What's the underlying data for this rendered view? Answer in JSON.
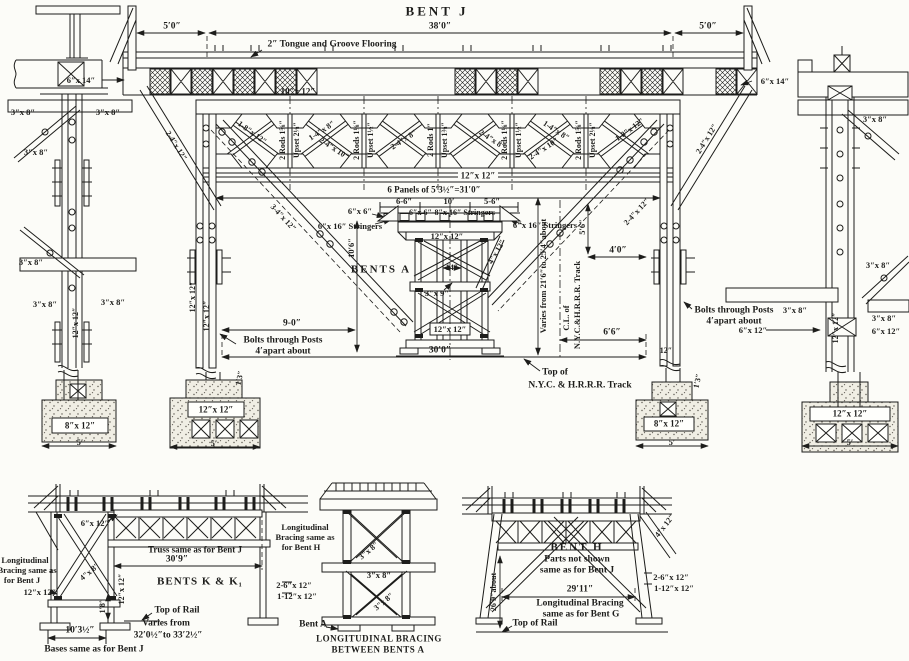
{
  "drawing": {
    "title": "BENT J",
    "colors": {
      "ink": "#1d1d1b",
      "paper": "#fcfcf8"
    },
    "annotations": [
      {
        "n": "title-bent-j",
        "t": "BENT J",
        "x": 437,
        "y": 11,
        "fs": 13,
        "ls": 3
      },
      {
        "n": "dim-5-0-left",
        "t": "5′0″",
        "x": 172,
        "y": 27,
        "fs": 9.5
      },
      {
        "n": "dim-38-0",
        "t": "38′0″",
        "x": 440,
        "y": 27,
        "fs": 9.5
      },
      {
        "n": "dim-5-0-right",
        "t": "5′0″",
        "x": 708,
        "y": 27,
        "fs": 9.5
      },
      {
        "n": "flooring-note",
        "t": "2″ Tongue and Groove Flooring",
        "x": 332,
        "y": 45,
        "fs": 9.5
      },
      {
        "n": "beam-6x14-left",
        "t": "6″x 14″",
        "x": 81,
        "y": 80,
        "fs": 8.5
      },
      {
        "n": "beam-6x14-right",
        "t": "6″x 14″",
        "x": 775,
        "y": 81,
        "fs": 8.5
      },
      {
        "n": "cap-10x12",
        "t": "10″x 12″",
        "x": 298,
        "y": 92,
        "fs": 9
      },
      {
        "n": "rod-1",
        "t": "2 Rods 1⅝″",
        "x": 283,
        "y": 140,
        "fs": 8,
        "r": -90
      },
      {
        "n": "upset-1",
        "t": "Upset 2⅛″",
        "x": 297,
        "y": 140,
        "fs": 8,
        "r": -90
      },
      {
        "n": "rod-2",
        "t": "2 Rods 1⅛″",
        "x": 357,
        "y": 140,
        "fs": 8,
        "r": -90
      },
      {
        "n": "upset-2",
        "t": "Upset 1½″",
        "x": 371,
        "y": 140,
        "fs": 8,
        "r": -90
      },
      {
        "n": "rod-3",
        "t": "2 Rods 1″",
        "x": 431,
        "y": 140,
        "fs": 8,
        "r": -90
      },
      {
        "n": "upset-3",
        "t": "Upset 1⅜″",
        "x": 445,
        "y": 140,
        "fs": 8,
        "r": -90
      },
      {
        "n": "rod-4",
        "t": "2 Rods 1⅛″",
        "x": 505,
        "y": 140,
        "fs": 8,
        "r": -90
      },
      {
        "n": "upset-4",
        "t": "Upset 1½″",
        "x": 519,
        "y": 140,
        "fs": 8,
        "r": -90
      },
      {
        "n": "rod-5",
        "t": "2 Rods 1⅝″",
        "x": 579,
        "y": 140,
        "fs": 8,
        "r": -90
      },
      {
        "n": "upset-5",
        "t": "Upset 2⅛″",
        "x": 593,
        "y": 140,
        "fs": 8,
        "r": -90
      },
      {
        "n": "diag-end-left",
        "t": "1-8″x 12″",
        "x": 252,
        "y": 133,
        "fs": 8,
        "r": 36
      },
      {
        "n": "diag-p2-a",
        "t": "1-4″x 8″",
        "x": 322,
        "y": 131,
        "fs": 8,
        "r": -33
      },
      {
        "n": "diag-p2-b",
        "t": "2-4″x 10″",
        "x": 334,
        "y": 149,
        "fs": 8,
        "r": 33
      },
      {
        "n": "diag-p3",
        "t": "2-4″x 8″",
        "x": 404,
        "y": 140,
        "fs": 8,
        "r": -33
      },
      {
        "n": "diag-p4",
        "t": "2-4″x 8″",
        "x": 492,
        "y": 140,
        "fs": 8,
        "r": 33
      },
      {
        "n": "diag-p5-a",
        "t": "1-4″x 8″",
        "x": 556,
        "y": 131,
        "fs": 8,
        "r": 33
      },
      {
        "n": "diag-p5-b",
        "t": "2-4″x 10″",
        "x": 544,
        "y": 149,
        "fs": 8,
        "r": -33
      },
      {
        "n": "diag-end-right",
        "t": "1-8″x 12″",
        "x": 630,
        "y": 130,
        "fs": 8,
        "r": -36
      },
      {
        "n": "batter-left",
        "t": "2-4″x 12″",
        "x": 176,
        "y": 146,
        "fs": 8,
        "r": 58
      },
      {
        "n": "batter-right",
        "t": "2-4″x 12″",
        "x": 707,
        "y": 139,
        "fs": 8,
        "r": -58
      },
      {
        "n": "long-diag-left",
        "t": "3-4″x 12″",
        "x": 283,
        "y": 218,
        "fs": 8,
        "r": 47
      },
      {
        "n": "long-diag-right",
        "t": "2-4″x 12″",
        "x": 637,
        "y": 212,
        "fs": 8,
        "r": -47
      },
      {
        "n": "chord-12x12",
        "t": "12″x 12″",
        "x": 478,
        "y": 176,
        "fs": 9
      },
      {
        "n": "panels-note",
        "t": "6 Panels of 5′3½″=31′0″",
        "x": 434,
        "y": 190,
        "fs": 9
      },
      {
        "n": "dim-6-6",
        "t": "6-6″",
        "x": 404,
        "y": 201,
        "fs": 8.5
      },
      {
        "n": "dim-10ft",
        "t": "10′",
        "x": 449,
        "y": 201,
        "fs": 8.5
      },
      {
        "n": "dim-5-6s",
        "t": "5-6″",
        "x": 492,
        "y": 201,
        "fs": 8.5
      },
      {
        "n": "stringers-cap",
        "t": "6″x 6″-8″x 16″ Stringers",
        "x": 452,
        "y": 213,
        "fs": 8
      },
      {
        "n": "six-by-six",
        "t": "6″x 6″",
        "x": 360,
        "y": 211,
        "fs": 8.5
      },
      {
        "n": "stringers-left",
        "t": "6″x 16″ Stringers",
        "x": 350,
        "y": 226,
        "fs": 8.5
      },
      {
        "n": "stringers-right",
        "t": "6″x 16″ Stringers",
        "x": 545,
        "y": 225,
        "fs": 8.5
      },
      {
        "n": "dim-10-6",
        "t": "10′6″",
        "x": 351,
        "y": 248,
        "fs": 8.5,
        "r": -90
      },
      {
        "n": "bents-a-title",
        "t": "BENTS A",
        "x": 381,
        "y": 270,
        "fs": 11,
        "ls": 2
      },
      {
        "n": "dim-14",
        "t": "14″",
        "x": 452,
        "y": 268,
        "fs": 8
      },
      {
        "n": "brace-3x9",
        "t": "3″x 9″",
        "x": 437,
        "y": 293,
        "fs": 8.5
      },
      {
        "n": "tower-12x12-top",
        "t": "12″x 12″",
        "x": 447,
        "y": 236,
        "fs": 8.5
      },
      {
        "n": "tower-12x12-sill",
        "t": "12″x 12″",
        "x": 450,
        "y": 329,
        "fs": 8.5
      },
      {
        "n": "tower-4x12",
        "t": "4″x 12″",
        "x": 497,
        "y": 252,
        "fs": 8,
        "r": -60
      },
      {
        "n": "dim-9-0",
        "t": "9-0″",
        "x": 292,
        "y": 324,
        "fs": 9.5
      },
      {
        "n": "bolts-left-1",
        "t": "Bolts through Posts",
        "x": 283,
        "y": 341,
        "fs": 9.5
      },
      {
        "n": "bolts-left-2",
        "t": "4′apart about",
        "x": 283,
        "y": 352,
        "fs": 9.5
      },
      {
        "n": "dim-30-0",
        "t": "30′0″",
        "x": 440,
        "y": 351,
        "fs": 9.5
      },
      {
        "n": "post-12x12-a",
        "t": "12″x 12″",
        "x": 193,
        "y": 297,
        "fs": 8,
        "r": -90
      },
      {
        "n": "post-12x12-b",
        "t": "12″x 12″",
        "x": 207,
        "y": 316,
        "fs": 8,
        "r": -90
      },
      {
        "n": "dim-5-6v",
        "t": "5′6″",
        "x": 582,
        "y": 227,
        "fs": 8.5,
        "r": -90
      },
      {
        "n": "dim-4-0",
        "t": "4′0″",
        "x": 618,
        "y": 251,
        "fs": 9.5
      },
      {
        "n": "varies-track",
        "t": "Varies from 21′6″to 25′4″about",
        "x": 543,
        "y": 276,
        "fs": 8.5,
        "r": -90
      },
      {
        "n": "cl-of",
        "t": "C.L. of",
        "x": 566,
        "y": 318,
        "fs": 8.5,
        "r": -90
      },
      {
        "n": "cl-track",
        "t": "N.Y.C.&H.R.R.R. Track",
        "x": 577,
        "y": 305,
        "fs": 8.5,
        "r": -90
      },
      {
        "n": "dim-6-6b",
        "t": "6′6″",
        "x": 612,
        "y": 333,
        "fs": 9.5
      },
      {
        "n": "post-base-12",
        "t": "12″",
        "x": 666,
        "y": 351,
        "fs": 8
      },
      {
        "n": "top-of-track-1",
        "t": "Top of",
        "x": 555,
        "y": 373,
        "fs": 9.5
      },
      {
        "n": "top-of-track-2",
        "t": "N.Y.C. & H.R.R.R. Track",
        "x": 580,
        "y": 386,
        "fs": 9.5
      },
      {
        "n": "bolts-right-1",
        "t": "Bolts through Posts",
        "x": 734,
        "y": 311,
        "fs": 9.5
      },
      {
        "n": "bolts-right-2",
        "t": "4′apart about",
        "x": 734,
        "y": 322,
        "fs": 9.5
      },
      {
        "n": "foot-left-12x12",
        "t": "12″x 12″",
        "x": 216,
        "y": 410,
        "fs": 9
      },
      {
        "n": "foot-left-5",
        "t": "5′",
        "x": 214,
        "y": 443,
        "fs": 8.5
      },
      {
        "n": "foot-left-1-3",
        "t": "1′3″",
        "x": 240,
        "y": 378,
        "fs": 8,
        "r": -78
      },
      {
        "n": "foot-right-8x12",
        "t": "8″x 12″",
        "x": 669,
        "y": 424,
        "fs": 9
      },
      {
        "n": "foot-right-5",
        "t": "5′",
        "x": 672,
        "y": 442,
        "fs": 8.5
      },
      {
        "n": "foot-right-1-3",
        "t": "1′3″",
        "x": 698,
        "y": 381,
        "fs": 8,
        "r": -78
      },
      {
        "n": "ldc-3x8-a",
        "t": "3″x 8″",
        "x": 23,
        "y": 112,
        "fs": 8.5
      },
      {
        "n": "ldc-3x8-b",
        "t": "3″x 8″",
        "x": 108,
        "y": 112,
        "fs": 8.5
      },
      {
        "n": "ldc-3x8-c",
        "t": "3″x 8″",
        "x": 36,
        "y": 152,
        "fs": 8.5
      },
      {
        "n": "ldc-3x8-d",
        "t": "3″x 8″",
        "x": 31,
        "y": 262,
        "fs": 8.5
      },
      {
        "n": "ldc-3x8-e",
        "t": "3″x 8″",
        "x": 45,
        "y": 304,
        "fs": 8.5
      },
      {
        "n": "ldc-3x8-f",
        "t": "3″x 8″",
        "x": 113,
        "y": 302,
        "fs": 8.5
      },
      {
        "n": "ldc-12x12",
        "t": "12″x 12″",
        "x": 76,
        "y": 323,
        "fs": 8,
        "r": -90
      },
      {
        "n": "ldc-foot-8x12",
        "t": "8″x 12″",
        "x": 80,
        "y": 426,
        "fs": 9
      },
      {
        "n": "ldc-foot-5",
        "t": "5′",
        "x": 80,
        "y": 442,
        "fs": 8.5
      },
      {
        "n": "rdc-3x8-a",
        "t": "3″x 8″",
        "x": 875,
        "y": 119,
        "fs": 8.5
      },
      {
        "n": "rdc-3x8-b",
        "t": "3″x 8″",
        "x": 878,
        "y": 265,
        "fs": 8.5
      },
      {
        "n": "rdc-3x8-c",
        "t": "3″x 8″",
        "x": 795,
        "y": 310,
        "fs": 8.5
      },
      {
        "n": "rdc-3x8-d",
        "t": "3″x 8″",
        "x": 884,
        "y": 318,
        "fs": 8.5
      },
      {
        "n": "rdc-12x12",
        "t": "12″x 12″",
        "x": 836,
        "y": 328,
        "fs": 8,
        "r": -90
      },
      {
        "n": "rdc-6x12-left",
        "t": "6″x 12″",
        "x": 753,
        "y": 330,
        "fs": 8.5
      },
      {
        "n": "rdc-6x12-right",
        "t": "6″x 12″",
        "x": 886,
        "y": 331,
        "fs": 8.5
      },
      {
        "n": "rdc-foot-12x12",
        "t": "12″x 12″",
        "x": 850,
        "y": 414,
        "fs": 9
      },
      {
        "n": "rdc-foot-5",
        "t": "5′",
        "x": 850,
        "y": 442,
        "fs": 8.5
      },
      {
        "n": "bl-longbrace-1",
        "t": "Longitudinal",
        "x": 25,
        "y": 560,
        "fs": 8.5
      },
      {
        "n": "bl-longbrace-2",
        "t": "Bracing same as",
        "x": 27,
        "y": 570,
        "fs": 8.5
      },
      {
        "n": "bl-longbrace-3",
        "t": "for Bent J",
        "x": 22,
        "y": 580,
        "fs": 8.5
      },
      {
        "n": "bl-6x12",
        "t": "6″x 12″",
        "x": 95,
        "y": 523,
        "fs": 8.5
      },
      {
        "n": "bl-truss-note",
        "t": "Truss same as for Bent J",
        "x": 195,
        "y": 550,
        "fs": 9
      },
      {
        "n": "bl-dim-30-9",
        "t": "30′9″",
        "x": 177,
        "y": 560,
        "fs": 9.5
      },
      {
        "n": "bl-title",
        "t": "BENTS K & K₁",
        "x": 200,
        "y": 582,
        "fs": 11,
        "ls": 1
      },
      {
        "n": "bl-4x8",
        "t": "4″x 8″",
        "x": 90,
        "y": 572,
        "fs": 8,
        "r": -40
      },
      {
        "n": "bl-12x12-left",
        "t": "12″x 12″",
        "x": 40,
        "y": 592,
        "fs": 8.5
      },
      {
        "n": "bl-12x12-post",
        "t": "12″x 12″",
        "x": 122,
        "y": 589,
        "fs": 8,
        "r": -90
      },
      {
        "n": "bl-dim-1-8",
        "t": "1′8″",
        "x": 103,
        "y": 606,
        "fs": 8,
        "r": -90
      },
      {
        "n": "bl-2-6x12",
        "t": "2-6″x 12″",
        "x": 294,
        "y": 585,
        "fs": 8.5
      },
      {
        "n": "bl-1-12x12",
        "t": "1-12″x 12″",
        "x": 297,
        "y": 596,
        "fs": 8.5
      },
      {
        "n": "bl-top-of-rail",
        "t": "Top of Rail",
        "x": 177,
        "y": 611,
        "fs": 9.5
      },
      {
        "n": "bl-varies-1",
        "t": "Varies from",
        "x": 166,
        "y": 624,
        "fs": 9.5
      },
      {
        "n": "bl-varies-2",
        "t": "32′0½″to 33′2½″",
        "x": 168,
        "y": 636,
        "fs": 9.5
      },
      {
        "n": "bl-dim-10-3",
        "t": "10′3½″",
        "x": 80,
        "y": 631,
        "fs": 9.5
      },
      {
        "n": "bl-bases-note",
        "t": "Bases same as for Bent J",
        "x": 94,
        "y": 650,
        "fs": 9.5
      },
      {
        "n": "bm-longbrace-1",
        "t": "Longitudinal",
        "x": 305,
        "y": 527,
        "fs": 8.5
      },
      {
        "n": "bm-longbrace-2",
        "t": "Bracing same as",
        "x": 305,
        "y": 537,
        "fs": 8.5
      },
      {
        "n": "bm-longbrace-3",
        "t": "for Bent H",
        "x": 301,
        "y": 547,
        "fs": 8.5
      },
      {
        "n": "bm-3x8-1",
        "t": "3″x 8″",
        "x": 369,
        "y": 551,
        "fs": 8,
        "r": -40
      },
      {
        "n": "bm-3x8-2",
        "t": "3″x 8″",
        "x": 379,
        "y": 575,
        "fs": 8.5
      },
      {
        "n": "bm-3x8-3",
        "t": "3″x 8″",
        "x": 384,
        "y": 602,
        "fs": 8,
        "r": -40
      },
      {
        "n": "bm-bent-a",
        "t": "Bent A",
        "x": 313,
        "y": 625,
        "fs": 9.5
      },
      {
        "n": "bm-caption-1",
        "t": "LONGITUDINAL BRACING",
        "x": 379,
        "y": 639,
        "fs": 9,
        "ls": 0.5
      },
      {
        "n": "bm-caption-2",
        "t": "BETWEEN BENTS A",
        "x": 378,
        "y": 650,
        "fs": 9,
        "ls": 0.5
      },
      {
        "n": "br-4x12",
        "t": "4″x 12″",
        "x": 665,
        "y": 526,
        "fs": 8,
        "r": -52
      },
      {
        "n": "br-title",
        "t": "BENT H",
        "x": 577,
        "y": 548,
        "fs": 11,
        "ls": 2
      },
      {
        "n": "br-note-1",
        "t": "Parts not shown",
        "x": 577,
        "y": 560,
        "fs": 9.5
      },
      {
        "n": "br-note-2",
        "t": "same as for Bent J",
        "x": 577,
        "y": 571,
        "fs": 9.5
      },
      {
        "n": "br-2-6x12",
        "t": "2-6″x 12″",
        "x": 671,
        "y": 577,
        "fs": 8.5
      },
      {
        "n": "br-1-12x12",
        "t": "1-12″x 12″",
        "x": 674,
        "y": 588,
        "fs": 8.5
      },
      {
        "n": "br-dim-29-11",
        "t": "29′11″",
        "x": 580,
        "y": 590,
        "fs": 9.5
      },
      {
        "n": "br-longbrace-1",
        "t": "Longitudinal Bracing",
        "x": 580,
        "y": 604,
        "fs": 9.5
      },
      {
        "n": "br-longbrace-2",
        "t": "same as for Bent G",
        "x": 581,
        "y": 615,
        "fs": 9.5
      },
      {
        "n": "br-top-of-rail",
        "t": "Top of Rail",
        "x": 535,
        "y": 624,
        "fs": 9.5
      },
      {
        "n": "br-dim-26-9",
        "t": "26′9″about",
        "x": 494,
        "y": 592,
        "fs": 8,
        "r": -90
      }
    ]
  }
}
